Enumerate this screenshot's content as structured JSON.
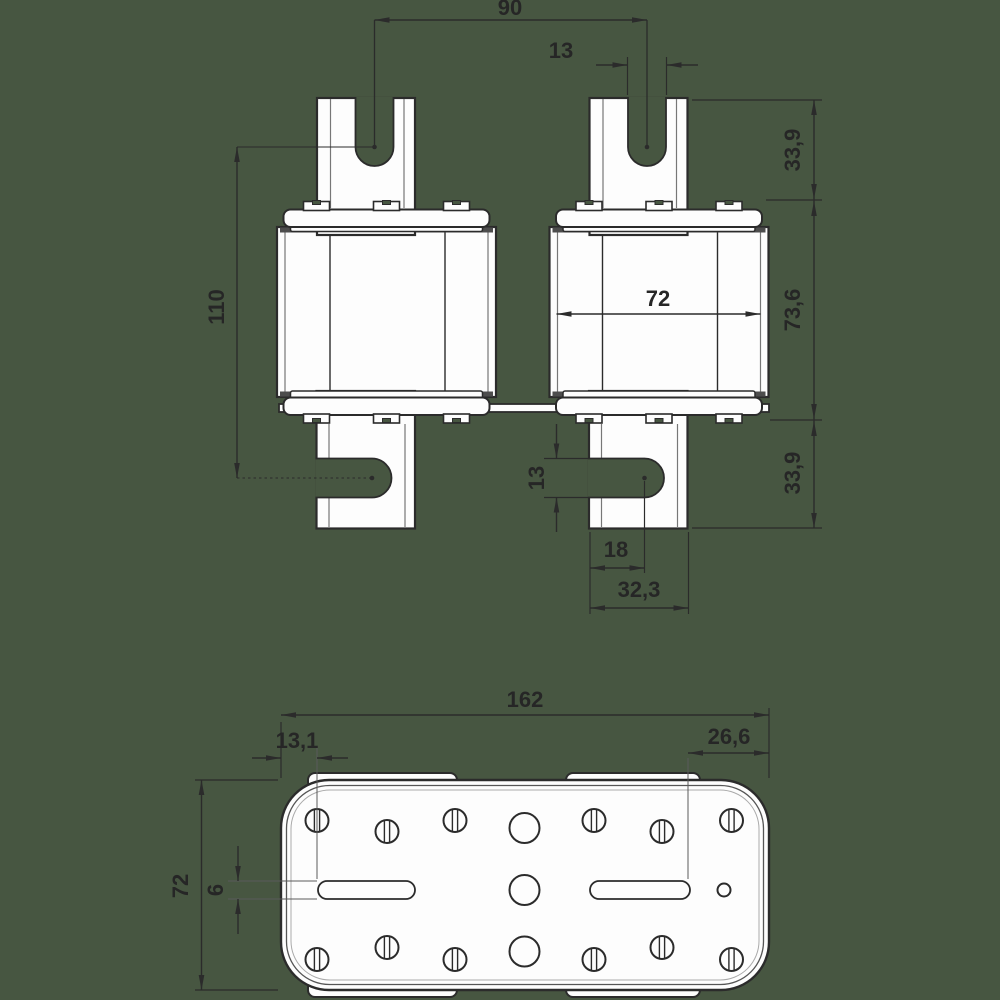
{
  "drawing": {
    "type": "technical-dimension-drawing",
    "subject": "NH fuse link with blade contacts, front view and bottom (plate) view"
  },
  "front_view": {
    "dims": {
      "blade_slot_span": "90",
      "top_blade_slot_width": "13",
      "top_blade_height": "33,9",
      "body_height": "73,6",
      "bottom_blade_height": "33,9",
      "slot_to_slot": "110",
      "body_width": "72",
      "bottom_slot_width": "13",
      "slot_center_offset": "18",
      "blade_width": "32,3"
    }
  },
  "top_view": {
    "dims": {
      "overall_width": "162",
      "left_slot_offset": "13,1",
      "right_slot_offset": "26,6",
      "overall_depth": "72",
      "slot_height": "6"
    }
  },
  "colors": {
    "background": "#475641",
    "line": "#2b2b2b",
    "fill": "#fdfdfd",
    "band": "#4d4d4d"
  }
}
